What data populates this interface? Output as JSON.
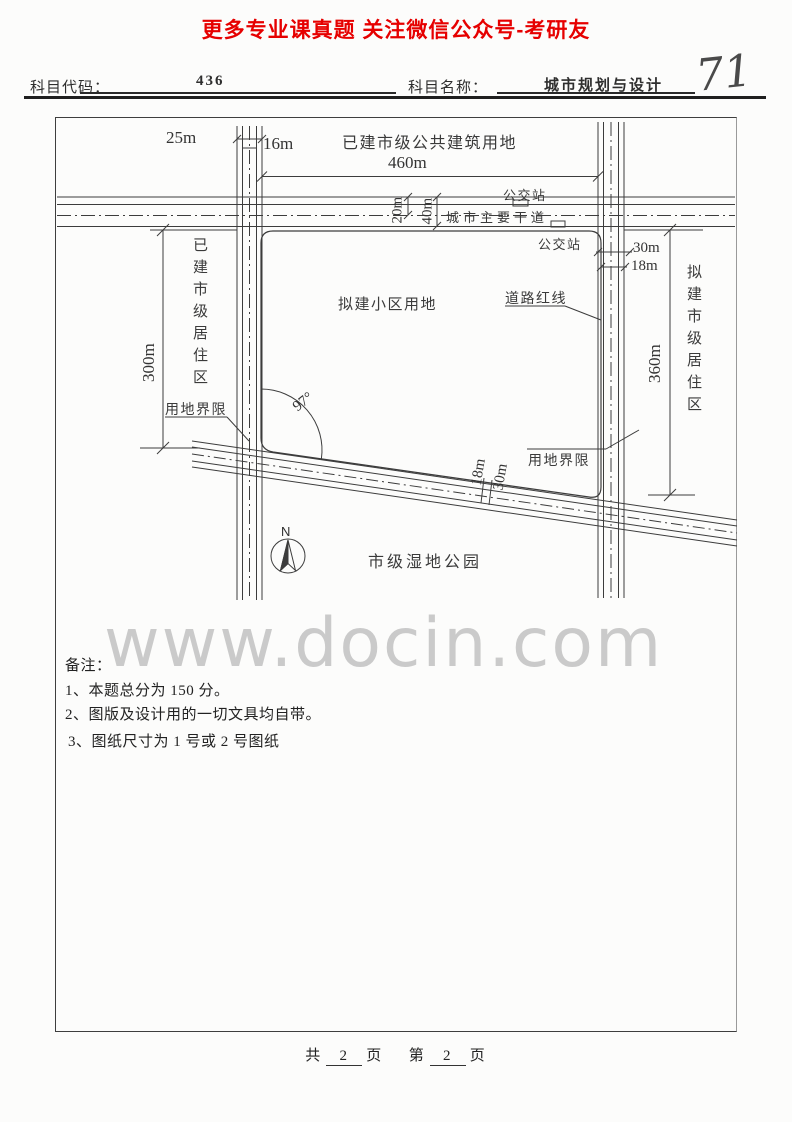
{
  "banner": {
    "text": "更多专业课真题 关注微信公众号-考研友"
  },
  "header": {
    "code_label": "科目代码：",
    "code_value": "436",
    "name_label": "科目名称：",
    "name_value": "城市规划与设计",
    "handwritten": "71"
  },
  "diagram": {
    "labels": {
      "public_land": "已建市级公共建筑用地",
      "dim_460": "460m",
      "bus_top": "公交站",
      "bus_bottom": "公交站",
      "main_road": "城市主要干道",
      "dim_20": "20m",
      "dim_40": "40m",
      "dim_25": "25m",
      "dim_16": "16m",
      "dim_30_right": "30m",
      "dim_18_right": "18m",
      "district_left": "已建市级居住区",
      "district_right": "拟建市级居住区",
      "dim_300": "300m",
      "dim_360": "360m",
      "site": "拟建小区用地",
      "road_red_line": "道路红线",
      "boundary_left": "用地界限",
      "boundary_right": "用地界限",
      "angle": "97°",
      "dim_18_diag": "18m",
      "dim_30_diag": "30m",
      "wetland": "市级湿地公园",
      "north": "N"
    }
  },
  "notes": {
    "title": "备注：",
    "item1": "1、本题总分为 150 分。",
    "item2": "2、图版及设计用的一切文具均自带。",
    "item3": "3、图纸尺寸为 1 号或 2 号图纸"
  },
  "watermark": {
    "text": "www.docin.com"
  },
  "footer": {
    "total_label": "共",
    "total_pages": "2",
    "unit1": "页",
    "page_label": "第",
    "current_page": "2",
    "unit2": "页"
  }
}
